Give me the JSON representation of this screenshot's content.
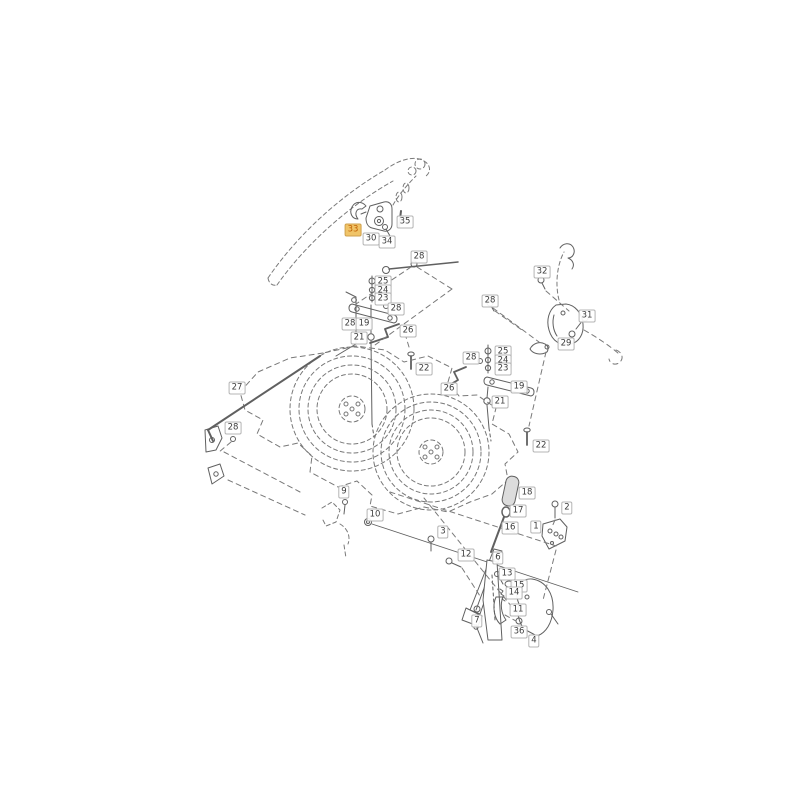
{
  "page": {
    "background": "#ffffff"
  },
  "diagram": {
    "type": "exploded-parts-diagram",
    "description": "Mower cutting deck exploded spare-parts drawing with numbered callouts",
    "highlighted_part": "33",
    "colors": {
      "line": "#606060",
      "dashed_line": "#7a7a7a",
      "label_text": "#3c3c3c",
      "label_border": "#b4b4b4",
      "label_bg": "#ffffff",
      "highlight_bg": "#f0c468",
      "highlight_text": "#c05f00",
      "highlight_border": "#cfa14e"
    },
    "labels": [
      {
        "text": "33",
        "x": 353,
        "y": 230,
        "highlighted": true
      },
      {
        "text": "30",
        "x": 371,
        "y": 239
      },
      {
        "text": "34",
        "x": 387,
        "y": 242
      },
      {
        "text": "35",
        "x": 405,
        "y": 222
      },
      {
        "text": "28",
        "x": 419,
        "y": 257
      },
      {
        "text": "25",
        "x": 383,
        "y": 282
      },
      {
        "text": "24",
        "x": 383,
        "y": 291
      },
      {
        "text": "23",
        "x": 383,
        "y": 299
      },
      {
        "text": "28",
        "x": 396,
        "y": 309
      },
      {
        "text": "28",
        "x": 350,
        "y": 324
      },
      {
        "text": "19",
        "x": 364,
        "y": 324
      },
      {
        "text": "26",
        "x": 408,
        "y": 331
      },
      {
        "text": "21",
        "x": 359,
        "y": 338
      },
      {
        "text": "22",
        "x": 424,
        "y": 369
      },
      {
        "text": "27",
        "x": 237,
        "y": 388
      },
      {
        "text": "28",
        "x": 233,
        "y": 428
      },
      {
        "text": "32",
        "x": 542,
        "y": 272
      },
      {
        "text": "28",
        "x": 490,
        "y": 301
      },
      {
        "text": "31",
        "x": 587,
        "y": 316
      },
      {
        "text": "29",
        "x": 566,
        "y": 344
      },
      {
        "text": "28",
        "x": 471,
        "y": 358
      },
      {
        "text": "25",
        "x": 503,
        "y": 352
      },
      {
        "text": "24",
        "x": 503,
        "y": 361
      },
      {
        "text": "23",
        "x": 503,
        "y": 369
      },
      {
        "text": "26",
        "x": 449,
        "y": 389
      },
      {
        "text": "19",
        "x": 519,
        "y": 387
      },
      {
        "text": "21",
        "x": 500,
        "y": 402
      },
      {
        "text": "22",
        "x": 541,
        "y": 446
      },
      {
        "text": "9",
        "x": 344,
        "y": 492
      },
      {
        "text": "10",
        "x": 375,
        "y": 515
      },
      {
        "text": "3",
        "x": 443,
        "y": 532
      },
      {
        "text": "12",
        "x": 466,
        "y": 555
      },
      {
        "text": "18",
        "x": 527,
        "y": 493
      },
      {
        "text": "17",
        "x": 518,
        "y": 511
      },
      {
        "text": "16",
        "x": 510,
        "y": 528
      },
      {
        "text": "2",
        "x": 567,
        "y": 508
      },
      {
        "text": "1",
        "x": 536,
        "y": 527
      },
      {
        "text": "6",
        "x": 498,
        "y": 558
      },
      {
        "text": "13",
        "x": 507,
        "y": 574
      },
      {
        "text": "15",
        "x": 519,
        "y": 586
      },
      {
        "text": "14",
        "x": 514,
        "y": 593
      },
      {
        "text": "11",
        "x": 518,
        "y": 610
      },
      {
        "text": "7",
        "x": 477,
        "y": 621
      },
      {
        "text": "36",
        "x": 519,
        "y": 632
      },
      {
        "text": "4",
        "x": 534,
        "y": 641
      }
    ]
  }
}
